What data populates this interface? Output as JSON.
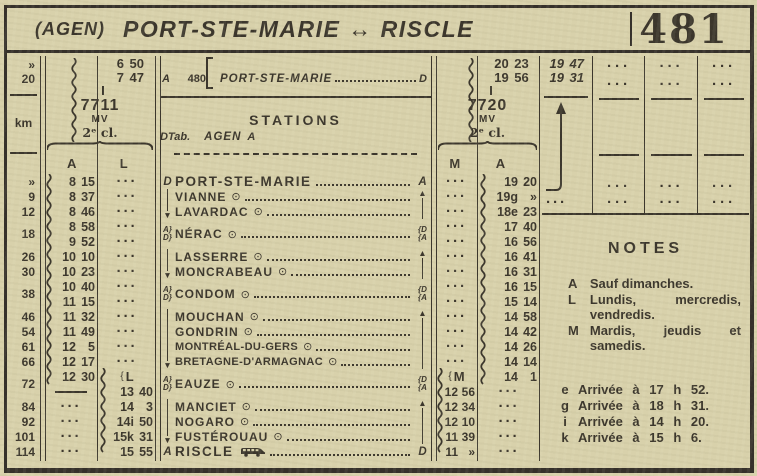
{
  "title": {
    "prefix": "(AGEN)",
    "main": "PORT-STE-MARIE",
    "arrow": "↔",
    "dest": "RISCLE",
    "number": "481"
  },
  "units": {
    "km": "km",
    "agen_km": "»",
    "psm_km": "20"
  },
  "ref_block": {
    "d": "D",
    "a": "A",
    "tab": "Tab.",
    "num": "480",
    "rows": [
      {
        "name": "AGEN",
        "end": "A"
      },
      {
        "name": "PORT-STE-MARIE",
        "end": "D"
      }
    ]
  },
  "train_left": {
    "t1": "6 50",
    "t2": "7 47",
    "number": "7711",
    "mv": "MV",
    "cls": "2ᵉ cl.",
    "colA": "A",
    "colB": "L"
  },
  "train_right": {
    "t1": "20 23",
    "t2": "19 56",
    "number": "7720",
    "mv": "MV",
    "cls": "2ᵉ cl.",
    "colA": "M",
    "colB": "A"
  },
  "stations_header": "STATIONS",
  "stations": [
    {
      "km": "»",
      "name": "PORT-STE-MARIE",
      "sym": false,
      "left": "D",
      "right": "A",
      "big": true
    },
    {
      "km": "9",
      "name": "VIANNE",
      "left": "line",
      "right": "up"
    },
    {
      "km": "12",
      "name": "LAVARDAC",
      "left": "down",
      "right": "line"
    },
    {
      "km": "18",
      "name": "NÉRAC",
      "left": "ad",
      "right": "da",
      "h2": true
    },
    {
      "km": "26",
      "name": "LASSERRE",
      "left": "line",
      "right": "up"
    },
    {
      "km": "30",
      "name": "MONCRABEAU",
      "left": "down",
      "right": "line"
    },
    {
      "km": "38",
      "name": "CONDOM",
      "left": "ad",
      "right": "da",
      "h2": true
    },
    {
      "km": "46",
      "name": "MOUCHAN",
      "left": "line",
      "right": "up"
    },
    {
      "km": "54",
      "name": "GONDRIN",
      "left": "line",
      "right": "line"
    },
    {
      "km": "61",
      "name": "MONTRÉAL-DU-GERS",
      "left": "line",
      "right": "line",
      "small": true
    },
    {
      "km": "66",
      "name": "BRETAGNE-D'ARMAGNAC",
      "left": "down",
      "right": "line",
      "small": true
    },
    {
      "km": "72",
      "name": "EAUZE",
      "left": "ad",
      "right": "da",
      "h2": true
    },
    {
      "km": "84",
      "name": "MANCIET",
      "left": "line",
      "right": "up"
    },
    {
      "km": "92",
      "name": "NOGARO",
      "left": "line",
      "right": "line"
    },
    {
      "km": "101",
      "name": "FUSTÉROUAU",
      "left": "down",
      "right": "line"
    },
    {
      "km": "114",
      "name": "RISCLE",
      "sym": false,
      "bus": true,
      "left": "A",
      "right": "D",
      "big": true
    }
  ],
  "cols": {
    "A": [
      "8 15",
      "8 37",
      "8 46",
      "8 58",
      "9 52",
      "10 10",
      "10 23",
      "10 40",
      "11 15",
      "11 32",
      "11 49",
      "12 5",
      "12 17",
      "12 30",
      "——",
      "···",
      "···",
      "···",
      "···"
    ],
    "L": [
      "···",
      "···",
      "···",
      "···",
      "···",
      "···",
      "···",
      "···",
      "···",
      "···",
      "···",
      "···",
      "···",
      "{L",
      "13 40",
      "14 3",
      "14i 50",
      "15k 31",
      "15 55"
    ],
    "M": [
      "···",
      "···",
      "···",
      "···",
      "···",
      "···",
      "···",
      "···",
      "···",
      "···",
      "···",
      "···",
      "···",
      "{M",
      "12 56",
      "12 34",
      "12 10",
      "11 39",
      "11 »"
    ],
    "A2": [
      "19 20",
      "19g »",
      "18e 23",
      "17 40",
      "16 56",
      "16 41",
      "16 31",
      "16 15",
      "15 14",
      "14 58",
      "14 42",
      "14 26",
      "14 14",
      "14 1",
      "···",
      "···",
      "···",
      "···",
      "···"
    ]
  },
  "right_grid": {
    "times": [
      "19 47",
      "19 31"
    ],
    "dots": "···",
    "empty_columns": 3
  },
  "notes": {
    "title": "NOTES",
    "legend": [
      {
        "key": "A",
        "text": "Sauf dimanches."
      },
      {
        "key": "L",
        "text": "Lundis, mercredis, vendredis."
      },
      {
        "key": "M",
        "text": "Mardis, jeudis et samedis."
      }
    ],
    "arrivals": [
      {
        "key": "e",
        "text": "Arrivée à 17 h 52."
      },
      {
        "key": "g",
        "text": "Arrivée à 18 h 31."
      },
      {
        "key": "i",
        "text": "Arrivée à 14 h 20."
      },
      {
        "key": "k",
        "text": "Arrivée à 15 h 6."
      }
    ]
  },
  "colors": {
    "paper": "#d8d1ab",
    "ink": "#3b362c"
  }
}
